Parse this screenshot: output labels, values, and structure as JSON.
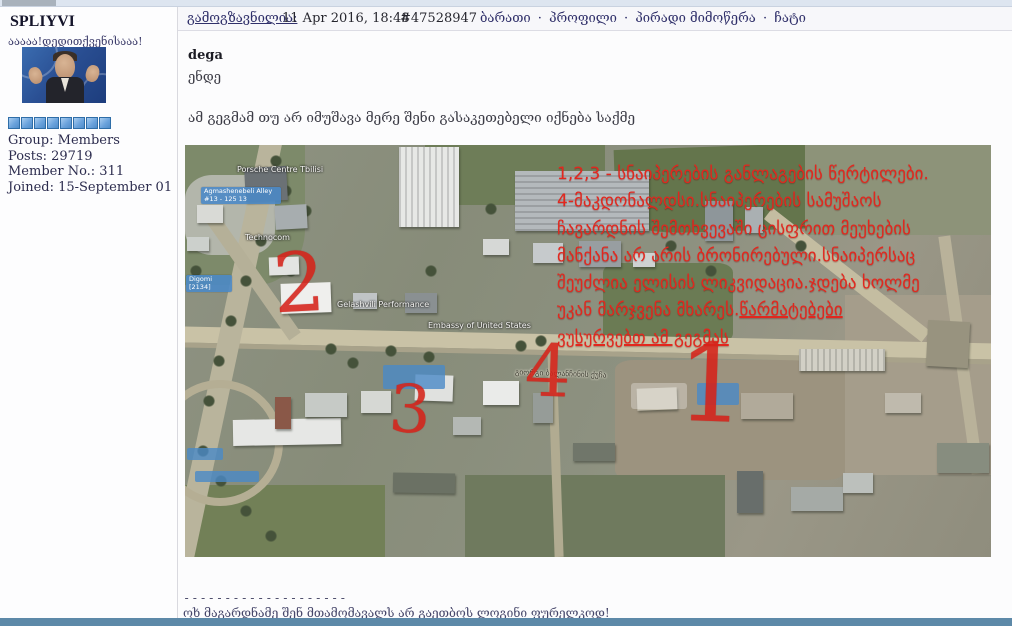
{
  "sidebar": {
    "username": "SPLIYVI",
    "user_title": "ააააა!დედითქვენისააა!",
    "rating_count": 8,
    "fields": [
      {
        "label": "Group:",
        "value": "Members"
      },
      {
        "label": "Posts:",
        "value": "29719"
      },
      {
        "label": "Member No.:",
        "value": "311"
      },
      {
        "label": "Joined:",
        "value": "15-September 01"
      }
    ]
  },
  "header": {
    "posted_label": "გამოგზავნილია:",
    "timestamp": "11 Apr 2016, 18:48",
    "post_id": "#47528947",
    "links": [
      "ბარათი",
      "პროფილი",
      "პირადი მიმოწერა",
      "ჩატი"
    ],
    "link_separator": "·"
  },
  "post": {
    "quote_author": "dega",
    "quote_text": "ენდე",
    "body_text": "ამ გეგმამ თუ არ იმუშავა მერე შენი გასაკეთებელი იქნება საქმე"
  },
  "map": {
    "red_annotation_lines": [
      {
        "text": "1,2,3 - სნაიპერების განლაგების წერტილები.",
        "underline": false
      },
      {
        "text": "4-მაკდონალდსი.სნაიპერების სამუშაოს",
        "underline": false
      },
      {
        "text": "ჩავარდნის შემთხვევაში ცისფრით მეუხების",
        "underline": false
      },
      {
        "text": "მანქანა არ არის ბრონირებული.სნაიპერსაც",
        "underline": false
      },
      {
        "text": "შეუძლია ელისის ლიკვიდაცია.ჯდება ხოლმე",
        "underline": false
      },
      {
        "text": "უკან მარჯვენა მხარეს.",
        "underline": false,
        "tail": "წარმატებები",
        "tail_underline": true
      },
      {
        "text": "ვუსურვებთ ამ გეგმას",
        "underline": true
      }
    ],
    "numerals": [
      {
        "n": "1",
        "x": 492,
        "y": 186,
        "size": 108,
        "rot": 2
      },
      {
        "n": "2",
        "x": 88,
        "y": 98,
        "size": 82,
        "rot": -3
      },
      {
        "n": "3",
        "x": 204,
        "y": 232,
        "size": 66,
        "rot": 3
      },
      {
        "n": "4",
        "x": 340,
        "y": 190,
        "size": 72,
        "rot": 2
      }
    ],
    "place_labels": [
      {
        "text": "Porsche Centre Tbilisi",
        "x": 52,
        "y": 20
      },
      {
        "text": "Technocom",
        "x": 60,
        "y": 88
      },
      {
        "text": "Gelashvili Performance",
        "x": 152,
        "y": 155
      },
      {
        "text": "Embassy of United States",
        "x": 243,
        "y": 176
      }
    ],
    "blue_labels": [
      {
        "text": "Agmashenebeli Alley #13 - 125 13",
        "x": 16,
        "y": 42,
        "w": 74
      },
      {
        "text": "Digomi [2134]",
        "x": 1,
        "y": 130,
        "w": 40
      }
    ],
    "street_label": "გიორგი ბალანჩინის ქუჩა"
  },
  "signature": {
    "divider": "--------------------",
    "text": "ოხ მაგარდნამე შენ მთამომავალს არ გაეთბოს ლოგინი ფურელკოდ!"
  },
  "colors": {
    "annotation_red": "#e2271e",
    "link_navy": "#30306a",
    "rating_blue": "#6ba3dc",
    "bottom_bar_blue": "#5d89a8"
  }
}
